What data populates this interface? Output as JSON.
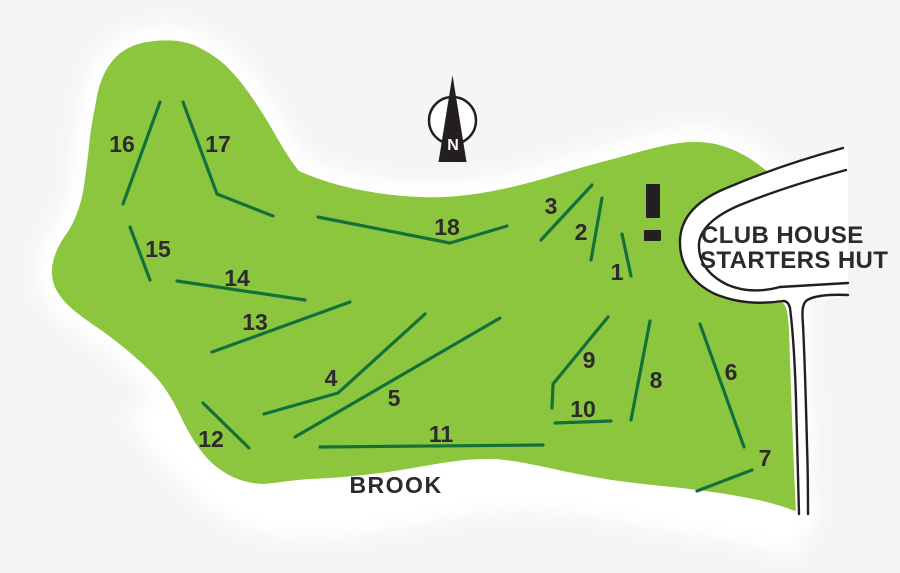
{
  "map": {
    "colors": {
      "background": "#f5f5f6",
      "course_green": "#8cc63e",
      "hole_line_green": "#14703b",
      "outline_black": "#231f20",
      "text_dark": "#2d2a2b"
    },
    "labels": {
      "club_house_line1": "CLUB HOUSE",
      "club_house_line2": "STARTERS HUT",
      "brook": "BROOK",
      "compass_north": "N"
    },
    "holes": [
      {
        "number": "1",
        "label": [
          617,
          272
        ],
        "line": [
          [
            622,
            234
          ],
          [
            631,
            276
          ]
        ]
      },
      {
        "number": "2",
        "label": [
          581,
          232
        ],
        "line": [
          [
            602,
            198
          ],
          [
            591,
            260
          ]
        ]
      },
      {
        "number": "3",
        "label": [
          551,
          206
        ],
        "line": [
          [
            592,
            185
          ],
          [
            541,
            240
          ]
        ]
      },
      {
        "number": "4",
        "label": [
          331,
          378
        ],
        "line": [
          [
            264,
            414
          ],
          [
            338,
            393
          ],
          [
            425,
            314
          ]
        ]
      },
      {
        "number": "5",
        "label": [
          394,
          398
        ],
        "line": [
          [
            295,
            437
          ],
          [
            500,
            318
          ]
        ]
      },
      {
        "number": "6",
        "label": [
          731,
          372
        ],
        "line": [
          [
            700,
            324
          ],
          [
            744,
            447
          ]
        ]
      },
      {
        "number": "7",
        "label": [
          765,
          458
        ],
        "line": [
          [
            752,
            470
          ],
          [
            697,
            491
          ]
        ]
      },
      {
        "number": "8",
        "label": [
          656,
          380
        ],
        "line": [
          [
            650,
            321
          ],
          [
            631,
            420
          ]
        ]
      },
      {
        "number": "9",
        "label": [
          589,
          360
        ],
        "line": [
          [
            608,
            317
          ],
          [
            553,
            384
          ],
          [
            552,
            408
          ]
        ]
      },
      {
        "number": "10",
        "label": [
          583,
          409
        ],
        "line": [
          [
            555,
            423
          ],
          [
            611,
            421
          ]
        ]
      },
      {
        "number": "11",
        "label": [
          441,
          434
        ],
        "line": [
          [
            320,
            447
          ],
          [
            543,
            445
          ]
        ]
      },
      {
        "number": "12",
        "label": [
          211,
          439
        ],
        "line": [
          [
            203,
            403
          ],
          [
            249,
            448
          ]
        ]
      },
      {
        "number": "13",
        "label": [
          255,
          322
        ],
        "line": [
          [
            212,
            352
          ],
          [
            350,
            302
          ]
        ]
      },
      {
        "number": "14",
        "label": [
          237,
          278
        ],
        "line": [
          [
            177,
            281
          ],
          [
            305,
            300
          ]
        ]
      },
      {
        "number": "15",
        "label": [
          158,
          249
        ],
        "line": [
          [
            130,
            227
          ],
          [
            150,
            280
          ]
        ]
      },
      {
        "number": "16",
        "label": [
          122,
          144
        ],
        "line": [
          [
            160,
            102
          ],
          [
            123,
            204
          ]
        ]
      },
      {
        "number": "17",
        "label": [
          218,
          144
        ],
        "line": [
          [
            183,
            102
          ],
          [
            217,
            194
          ],
          [
            273,
            216
          ]
        ]
      },
      {
        "number": "18",
        "label": [
          447,
          227
        ],
        "line": [
          [
            318,
            217
          ],
          [
            450,
            243
          ],
          [
            507,
            226
          ]
        ]
      }
    ]
  }
}
